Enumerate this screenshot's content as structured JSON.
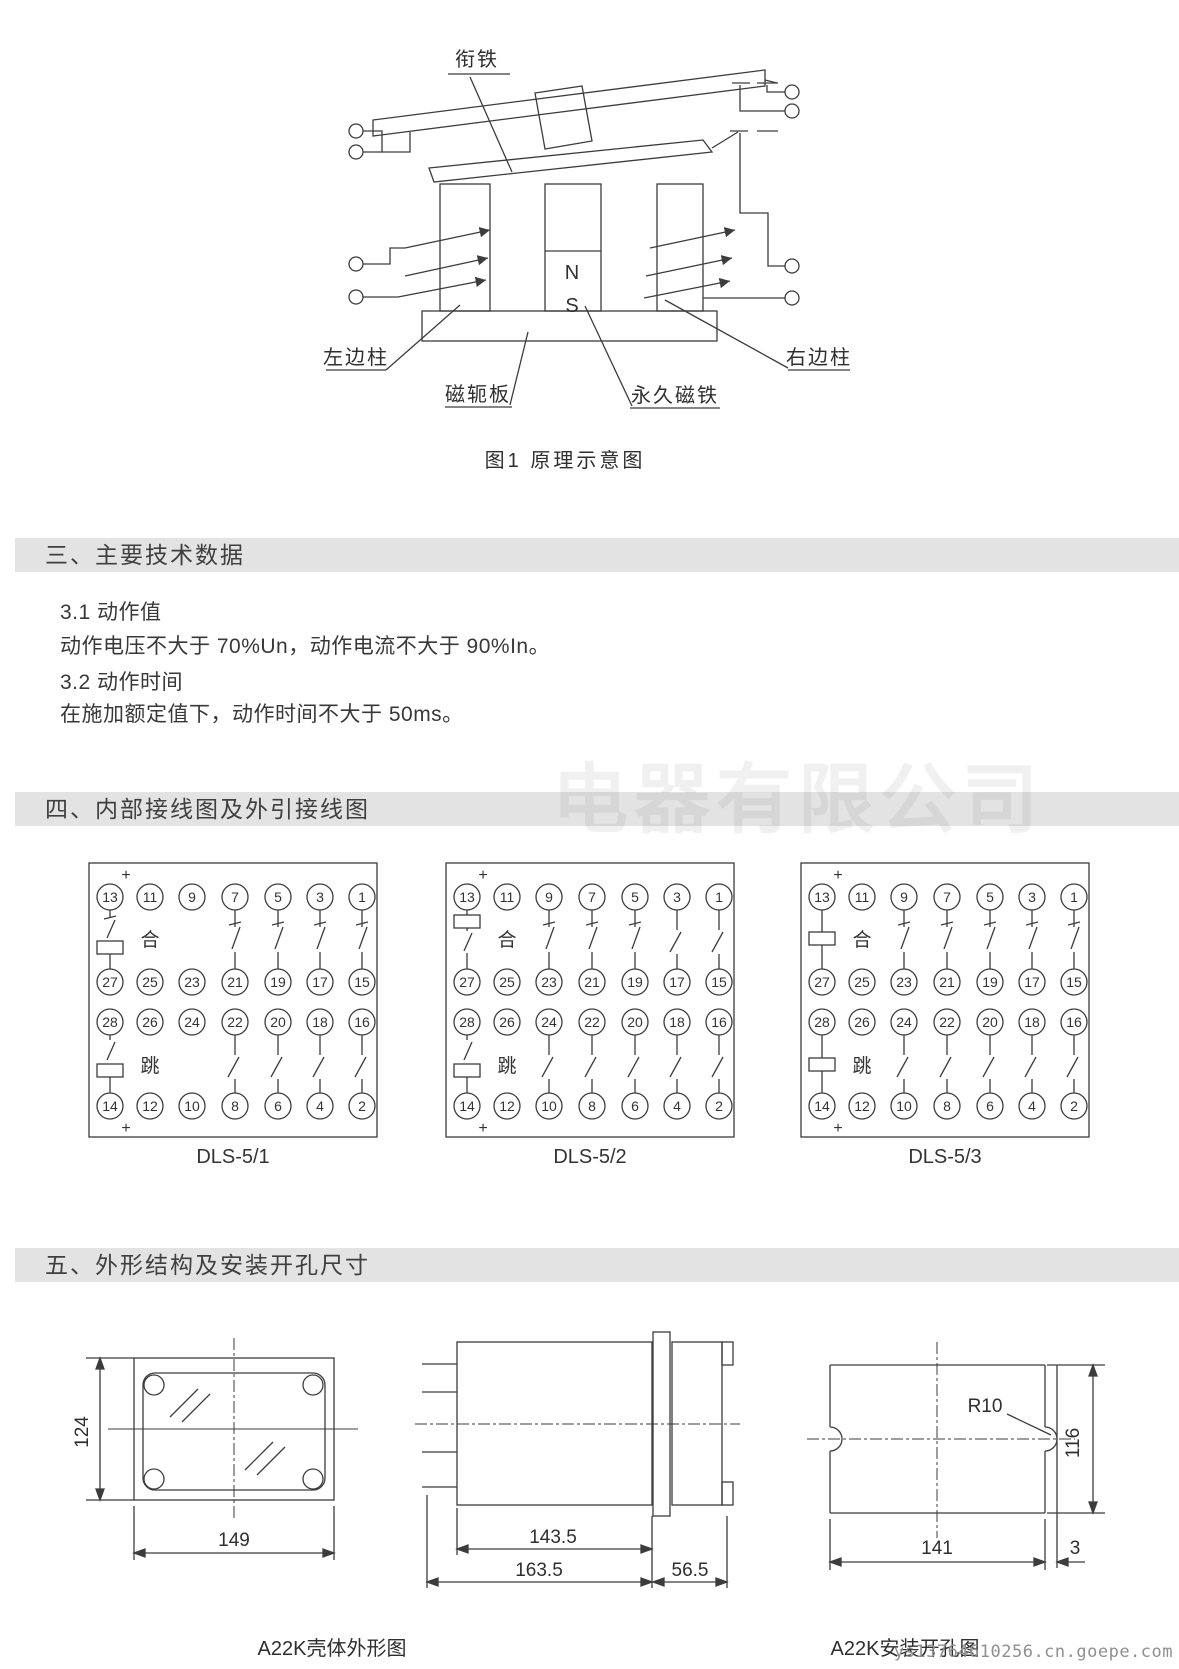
{
  "figure1": {
    "caption": "图1 原理示意图",
    "labels": {
      "armature": "衔铁",
      "left_column": "左边柱",
      "right_column": "右边柱",
      "yoke_plate": "磁轭板",
      "permanent_magnet": "永久磁铁",
      "pole_n": "N",
      "pole_s": "S"
    }
  },
  "section3": {
    "heading": "三、主要技术数据",
    "items": [
      "3.1 动作值",
      "动作电压不大于 70%Un，动作电流不大于 90%In。",
      "3.2 动作时间",
      "在施加额定值下，动作时间不大于 50ms。"
    ]
  },
  "section4": {
    "heading": "四、内部接线图及外引接线图",
    "close_label": "合",
    "trip_label": "跳",
    "plus": "+",
    "terminal_rows": [
      [
        "13",
        "11",
        "9",
        "7",
        "5",
        "3",
        "1"
      ],
      [
        "27",
        "25",
        "23",
        "21",
        "19",
        "17",
        "15"
      ],
      [
        "28",
        "26",
        "24",
        "22",
        "20",
        "18",
        "16"
      ],
      [
        "14",
        "12",
        "10",
        "8",
        "6",
        "4",
        "2"
      ]
    ],
    "diagrams": [
      {
        "label": "DLS-5/1",
        "top_coil": "sc",
        "bottom_coil": "sc",
        "top_contacts": [
          null,
          null,
          "hook",
          "hook",
          "hook",
          "hook"
        ],
        "bottom_contacts": [
          null,
          null,
          "slant",
          "slant",
          "slant",
          "slant"
        ]
      },
      {
        "label": "DLS-5/2",
        "top_coil": "cs",
        "bottom_coil": "sc",
        "top_contacts": [
          null,
          "hook",
          "hook",
          "hook",
          "slant",
          "slant"
        ],
        "bottom_contacts": [
          null,
          "slant",
          "slant",
          "slant",
          "slant",
          "slant"
        ]
      },
      {
        "label": "DLS-5/3",
        "top_coil": "c",
        "bottom_coil": "c",
        "top_contacts": [
          null,
          "hook",
          "hook",
          "hook",
          "hook",
          "hook"
        ],
        "bottom_contacts": [
          null,
          "slant",
          "slant",
          "slant",
          "slant",
          "slant"
        ]
      }
    ]
  },
  "section5": {
    "heading": "五、外形结构及安装开孔尺寸",
    "outline_drawing": {
      "caption": "A22K壳体外形图",
      "dims": {
        "front_height": "124",
        "front_width": "149",
        "body_length": "143.5",
        "overall_length": "163.5",
        "rear_length": "56.5"
      }
    },
    "cutout_drawing": {
      "caption": "A22K安装开孔图",
      "dims": {
        "radius": "R10",
        "height": "116",
        "width": "141",
        "offset": "3"
      }
    }
  },
  "watermark": {
    "ghost": "电器有限公司",
    "url": "ys13764610256.cn.goepe.com"
  }
}
